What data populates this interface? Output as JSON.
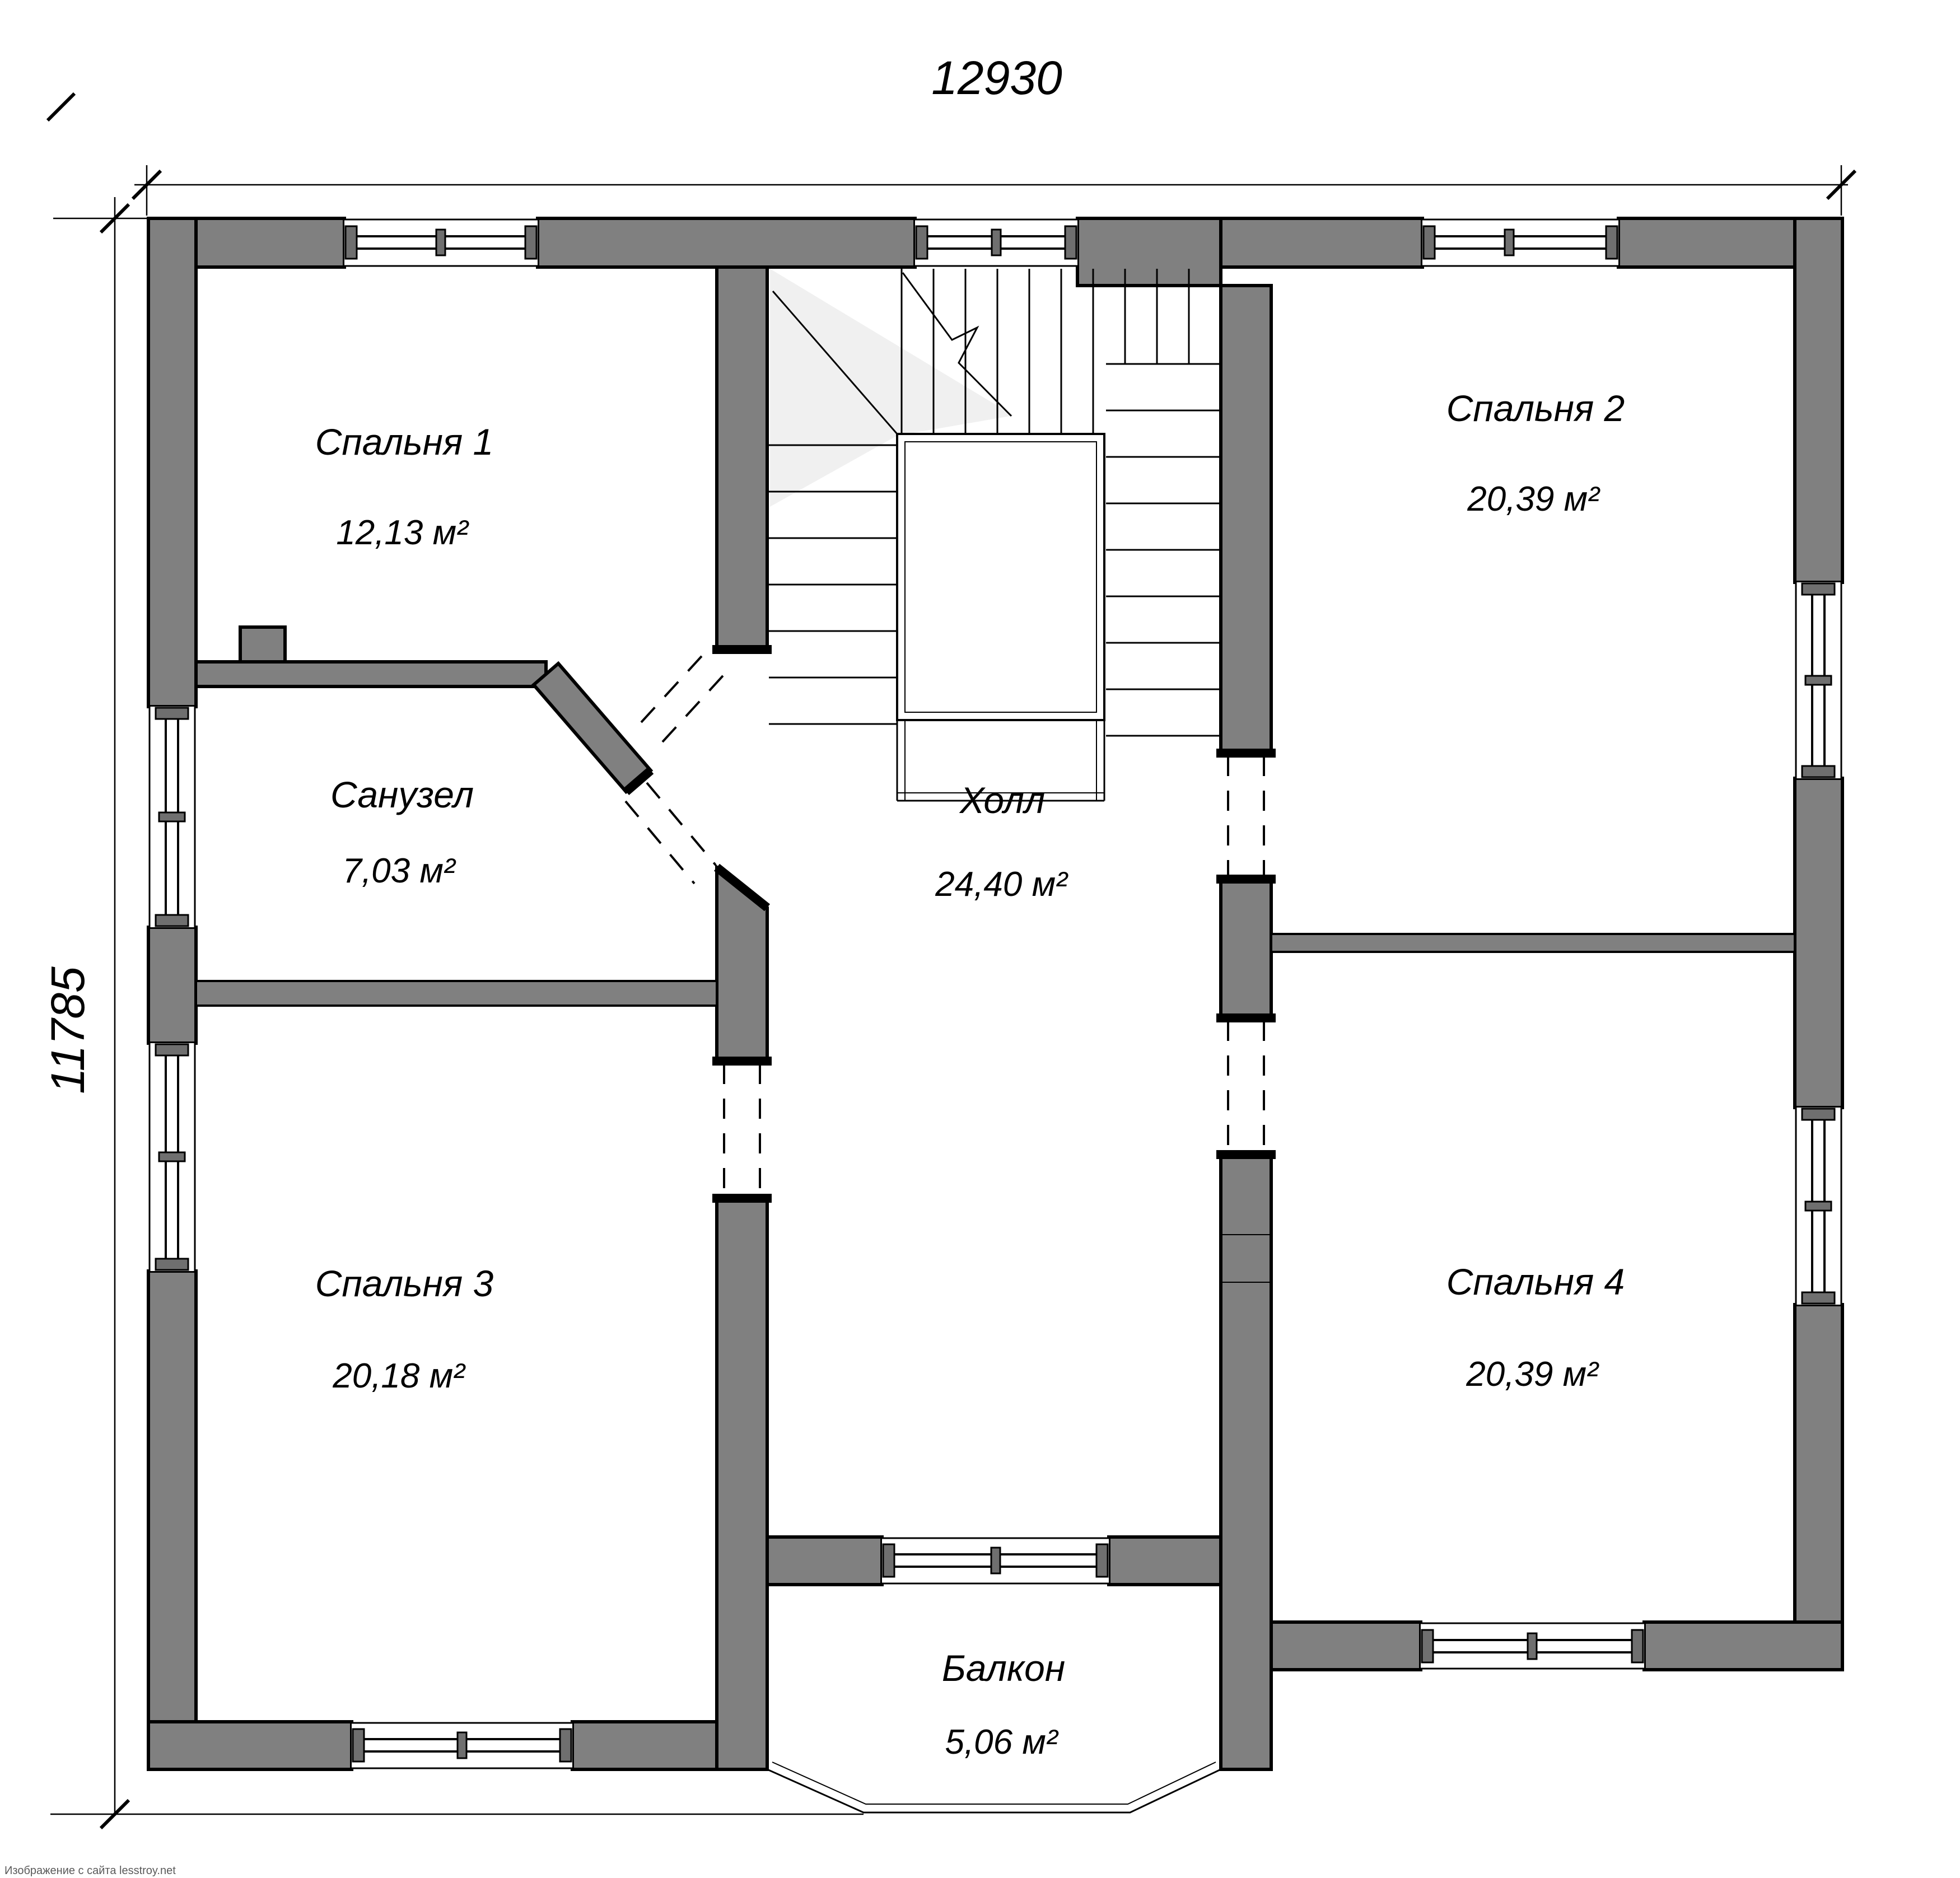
{
  "plan": {
    "title": "Floor plan — second floor",
    "dimensions": {
      "width_mm": "12930",
      "height_mm": "11785"
    },
    "rooms": [
      {
        "id": "bedroom1",
        "name": "Спальня 1",
        "area": "12,13 м²"
      },
      {
        "id": "bedroom2",
        "name": "Спальня 2",
        "area": "20,39 м²"
      },
      {
        "id": "bathroom",
        "name": "Санузел",
        "area": "7,03 м²"
      },
      {
        "id": "hall",
        "name": "Холл",
        "area": "24,40 м²"
      },
      {
        "id": "bedroom3",
        "name": "Спальня 3",
        "area": "20,18 м²"
      },
      {
        "id": "bedroom4",
        "name": "Спальня 4",
        "area": "20,39 м²"
      },
      {
        "id": "balcony",
        "name": "Балкон",
        "area": "5,06 м²"
      }
    ],
    "watermark": "Изображение с сайта lesstroy.net",
    "colors": {
      "wall_fill": "#808080",
      "line": "#000000",
      "stair_shade": "#f0f0f0",
      "watermark_text": "#5a5a5a",
      "background": "#ffffff"
    }
  }
}
